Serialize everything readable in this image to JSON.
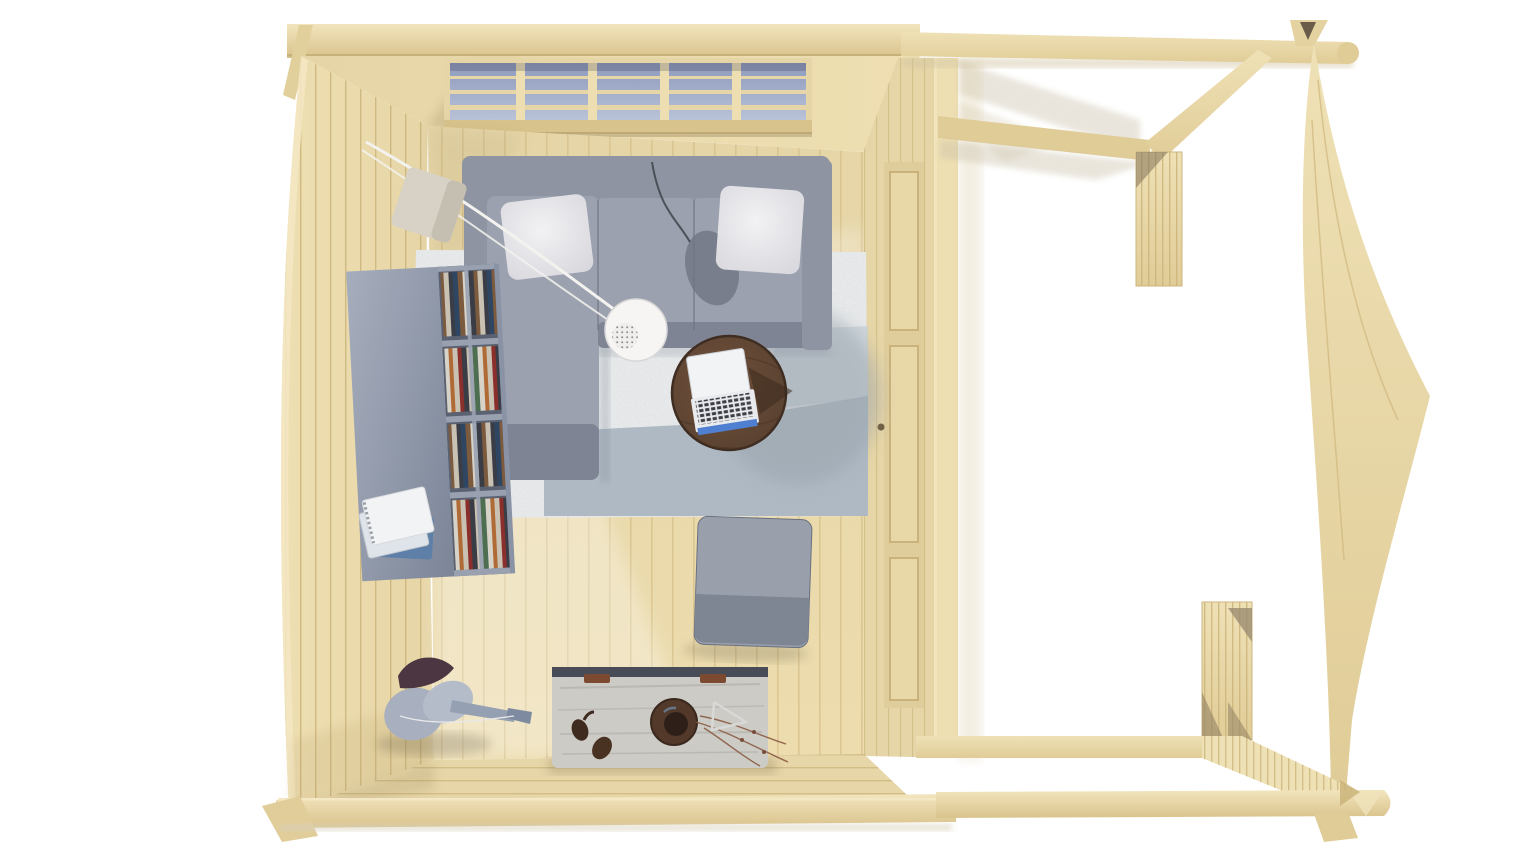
{
  "meta": {
    "title": "Top-down 3D render of a log cabin interior with an open side canopy",
    "view": "top-down-3d-render",
    "background": "#ffffff"
  },
  "colors": {
    "wood_highlight": "#f2e5bd",
    "wood_light": "#eedfb2",
    "wood_mid": "#e6d5a6",
    "wood_dark": "#d9c38c",
    "wood_line": "#cdb67f",
    "wood_beam_light": "#efe1b6",
    "wood_beam_dark": "#e0cc97",
    "floor_light": "#ecdcae",
    "floor_mid": "#e5d5a7",
    "floor_line": "#d5bf8a",
    "south_wall": "#e7d6a7",
    "door_panel": "#e8d8a8",
    "door_recess": "#dfcd9c",
    "glass_dark": "#8e9abc",
    "glass_light": "#b8c2d8",
    "sofa_base": "#8e94a2",
    "sofa_cushion": "#9ba1ae",
    "sofa_dark": "#7e8493",
    "sofa_seam": "#6d7380",
    "pillow_white": "#f2f1f3",
    "pillow_edge": "#d6d6dc",
    "rug_base": "#eceded",
    "rug_blue": "#a7b4bf",
    "rug_blue_light": "#c6cfd6",
    "rug_shadow": "#98a2ab",
    "shelf_top_light": "#a6aebd",
    "shelf_top_dark": "#7c8598",
    "shelf_inner": "#5a6170",
    "shelf_divider": "#99a1b1",
    "books": [
      "#3a3d45",
      "#7b5a3e",
      "#c9c1b2",
      "#4e6e52",
      "#8a2f2b",
      "#d8d3c8",
      "#2f4662",
      "#b06a35"
    ],
    "notebook_white": "#f2f3f4",
    "notebook_blue": "#5d7fa8",
    "table_center": "#6e4f3a",
    "table_edge": "#57402f",
    "table_rim": "#3f2d21",
    "laptop_lid": "#f2f3f4",
    "laptop_base": "#e8eaed",
    "laptop_keys": "#3c3f46",
    "laptop_screen_blue": "#4f7fd0",
    "ottoman_top": "#9aa0ab",
    "ottoman_bottom": "#7e8593",
    "chest_wood": "#cccbc5",
    "chest_streak": "#b5b4ae",
    "chest_metal": "#474c56",
    "chest_rust": "#7c4a31",
    "bowl_dark": "#53392a",
    "bowl_inner": "#2e2019",
    "lamp_white": "#f6f5f3",
    "lamp_holes": "#8f8f8f",
    "lamp_cord": "#f3f2ef",
    "lamp_base": "#d8d2c6",
    "guitar_cloth": "#a8b0bf",
    "guitar_cloth_light": "#b4bcc9",
    "guitar_dark": "#4c3642",
    "guitar_neck": "#95a0b2",
    "shadow_warm": "#c9bba0",
    "shadow_cool": "#8a93a0"
  },
  "scene": {
    "building": {
      "type": "log cabin seen from directly above",
      "left_section": "furnished interior room",
      "right_section": "open timber side canopy (pergola) frame",
      "wood": "untreated pale pine"
    },
    "objects": [
      {
        "name": "glazed-front-wall",
        "description": "window band with muntin bars along the top wall"
      },
      {
        "name": "corner-sofa",
        "description": "L-shaped gray corner sofa with chaise and two white pillows"
      },
      {
        "name": "floor-lamp",
        "description": "arc floor lamp with white perforated dome and stone base"
      },
      {
        "name": "bookshelf",
        "description": "slate-blue low bookshelf filled with books, notebooks on top"
      },
      {
        "name": "area-rug",
        "description": "light speckled rug with blue-gray band"
      },
      {
        "name": "coffee-table",
        "description": "round dark walnut coffee table"
      },
      {
        "name": "laptop",
        "description": "open laptop lying on the coffee table"
      },
      {
        "name": "ottoman",
        "description": "square gray ottoman on the floor"
      },
      {
        "name": "storage-chest",
        "description": "weathered wooden chest with bowl, twigs and decor on top"
      },
      {
        "name": "guitar",
        "description": "guitar with cloth lying near the bottom wall"
      },
      {
        "name": "partition-door",
        "description": "paneled door in the wall between the room and the canopy"
      },
      {
        "name": "side-canopy",
        "description": "open beam frame with two railing segments and floor beams"
      }
    ]
  }
}
